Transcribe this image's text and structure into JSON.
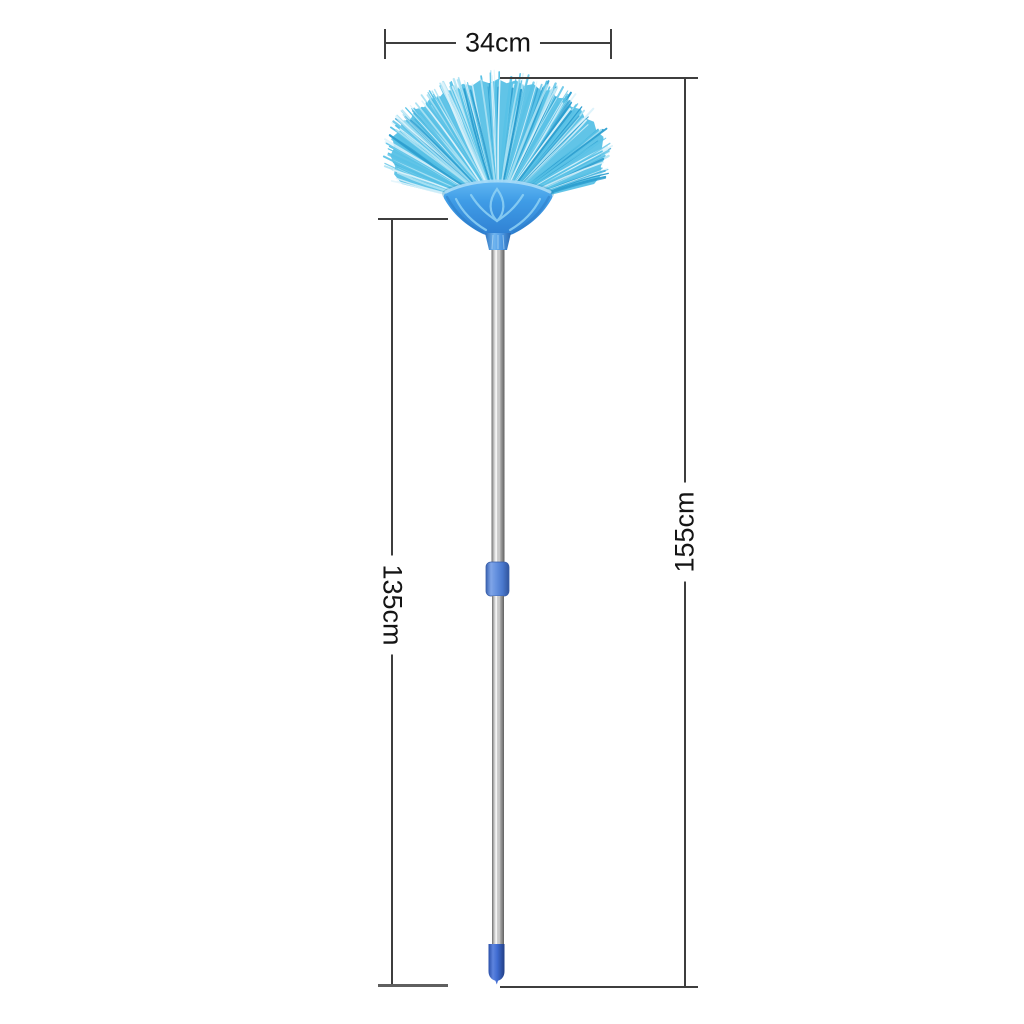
{
  "figure": {
    "background": "#ffffff",
    "annotations": {
      "width": {
        "label": "34cm"
      },
      "total_length": {
        "label": "155cm"
      },
      "pole_length": {
        "label": "135cm"
      }
    },
    "dimension_style": {
      "line_color": "#3e3e3e",
      "label_color": "#141414"
    },
    "illustration": {
      "name": "blue-fan-broom-with-telescopic-handle",
      "colors": {
        "bristles": "#58c1e6",
        "bristles_dark": "#2d9ecf",
        "bristles_light": "#a9e1f3",
        "bristles_sheen": "#ddf3fb",
        "head_plastic": "#3f9ce6",
        "head_pattern": "#8fd2f5",
        "socket_blue": "#3c86d6",
        "grip_collar": "#5f88d9",
        "tip_blue": "#3a63cf",
        "pole_gray": "#bfbfbf"
      }
    }
  }
}
